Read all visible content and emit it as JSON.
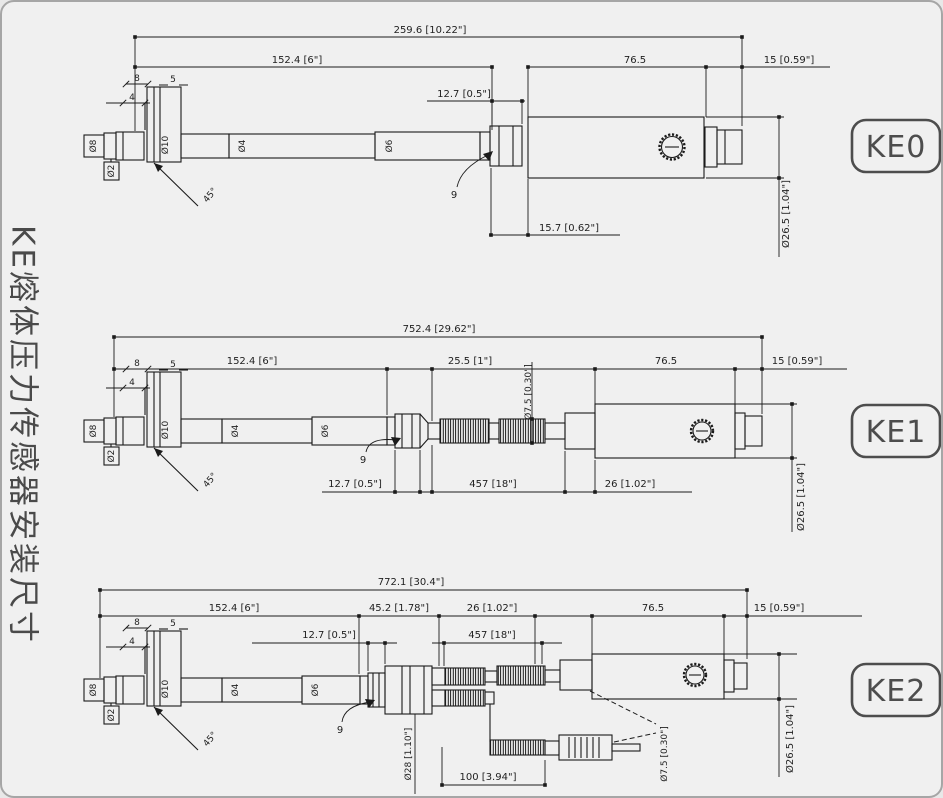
{
  "page": {
    "background": "#f0f0f0",
    "border_color": "#a6a6a6",
    "line_color": "#1b1b1b",
    "text_color": "#1f1f1f",
    "label_gray": "#4d4d4d",
    "side_title": "KE熔体压力传感器安装尺寸"
  },
  "front_end": {
    "len_8": "8",
    "len_5": "5",
    "len_4": "4",
    "angle_45": "45°",
    "dia_tip": "Ø8",
    "dia_hole": "Ø2",
    "dia_thread": "Ø10",
    "dia_stem_a": "Ø4",
    "dia_stem_b": "Ø6",
    "hex_width": "9"
  },
  "variants": [
    {
      "label": "KE0",
      "dims": {
        "total": "259.6 [10.22\"]",
        "stem": "152.4 [6\"]",
        "housing": "76.5",
        "rear": "15 [0.59\"]",
        "hex_nut": "12.7 [0.5\"]",
        "nut_to_housing": "15.7 [0.62\"]",
        "housing_dia": "Ø26.5 [1.04\"]"
      }
    },
    {
      "label": "KE1",
      "dims": {
        "total": "752.4 [29.62\"]",
        "stem": "152.4 [6\"]",
        "hex_section": "25.5 [1\"]",
        "housing": "76.5",
        "rear": "15 [0.59\"]",
        "hex_nut": "12.7 [0.5\"]",
        "flex_conduit": "457 [18\"]",
        "coupling": "26 [1.02\"]",
        "conduit_dia": "Ø7.5 [0.30\"]",
        "housing_dia": "Ø26.5 [1.04\"]"
      }
    },
    {
      "label": "KE2",
      "dims": {
        "total": "772.1 [30.4\"]",
        "stem": "152.4 [6\"]",
        "transition": "45.2 [1.78\"]",
        "coupling": "26 [1.02\"]",
        "hex_nut": "12.7 [0.5\"]",
        "flex_conduit": "457 [18\"]",
        "housing": "76.5",
        "rear": "15 [0.59\"]",
        "tc_cable": "100 [3.94\"]",
        "coupling_dia": "Ø28 [1.10\"]",
        "plug_dia": "Ø7.5 [0.30\"]",
        "housing_dia": "Ø26.5 [1.04\"]"
      }
    }
  ]
}
